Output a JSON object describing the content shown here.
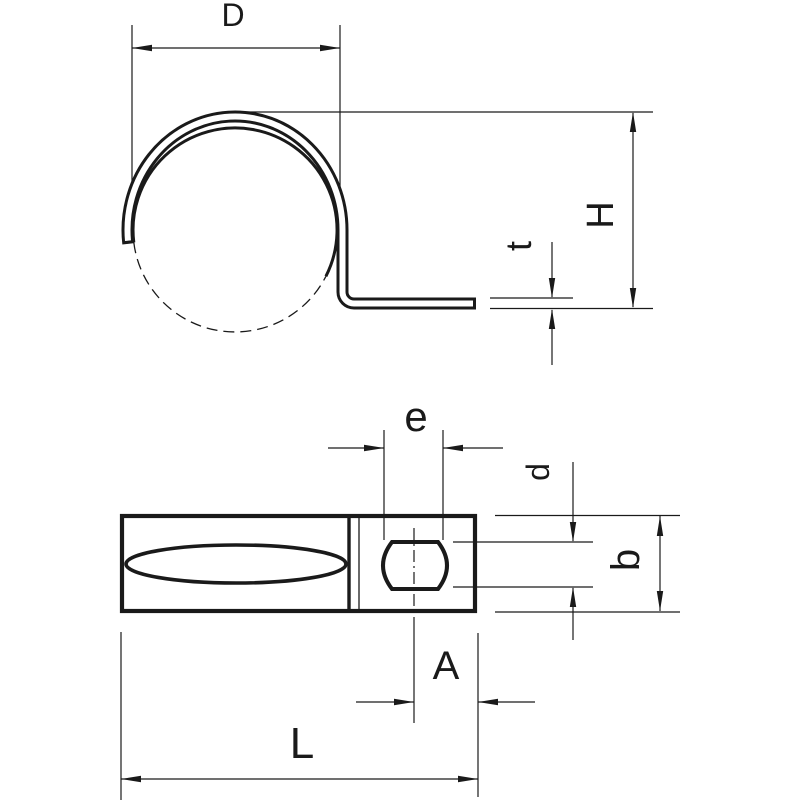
{
  "drawing": {
    "colors": {
      "line": "#1a1a1a",
      "background": "#ffffff"
    },
    "views": {
      "side": {
        "dimensions": [
          {
            "label": "D"
          },
          {
            "label": "H"
          },
          {
            "label": "t"
          }
        ]
      },
      "plan": {
        "dimensions": [
          {
            "label": "e"
          },
          {
            "label": "d"
          },
          {
            "label": "b"
          },
          {
            "label": "A"
          },
          {
            "label": "L"
          }
        ]
      }
    }
  }
}
